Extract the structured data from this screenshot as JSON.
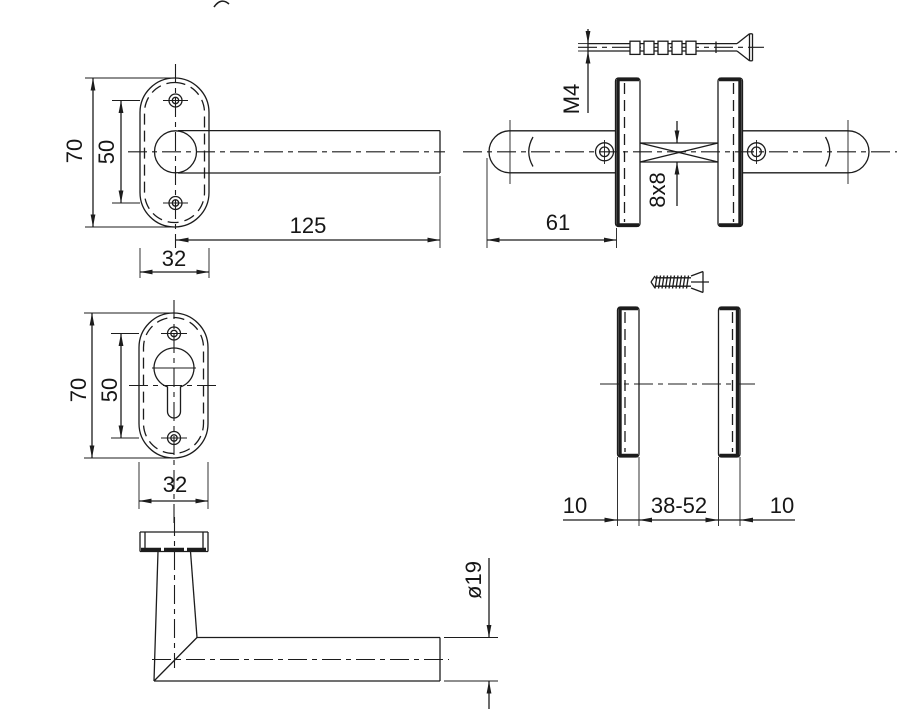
{
  "drawing": {
    "type": "technical-drawing",
    "subject": "Door handle set with oval roses - dimensioned views",
    "line_color": "#1c1c1c",
    "background": "#ffffff",
    "views": {
      "front_handle": {
        "label": "handle with oval rose, front view",
        "dims": {
          "height": "70",
          "hole_spacing": "50",
          "length": "125",
          "width": "32"
        }
      },
      "side_assembly": {
        "label": "handle pair on door, side view with fixing screw and spindle",
        "dims": {
          "screw_thread": "M4",
          "spindle": "8x8",
          "projection": "61"
        }
      },
      "front_cylinder_rose": {
        "label": "cylinder rose, front view",
        "dims": {
          "height": "70",
          "hole_spacing": "50",
          "width": "32"
        }
      },
      "side_roses": {
        "label": "roses on door, side view with wood screw",
        "dims": {
          "rose_thickness_left": "10",
          "door_thickness_range": "38-52",
          "rose_thickness_right": "10"
        }
      },
      "profile_handle": {
        "label": "handle profile view",
        "dims": {
          "grip_diameter": "ø19"
        }
      }
    }
  }
}
